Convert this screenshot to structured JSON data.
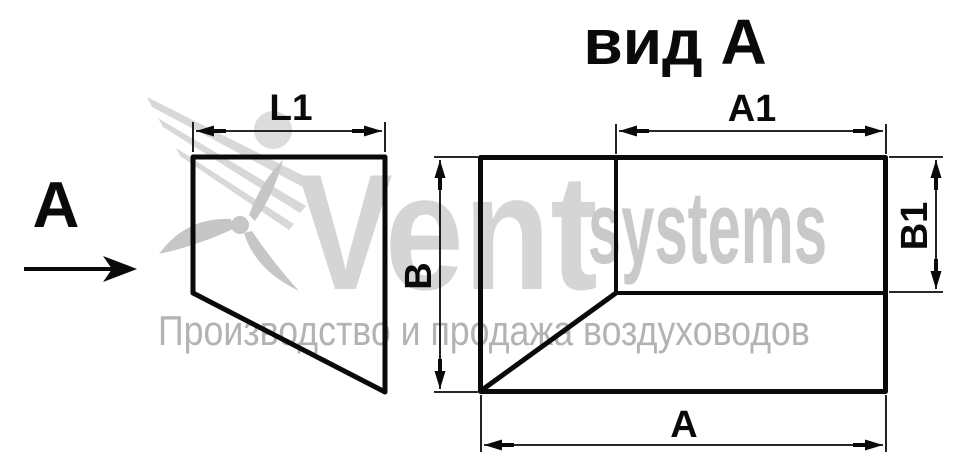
{
  "drawing": {
    "side_view": {
      "view_direction_label": "А",
      "dim_top_label": "L1"
    },
    "view_a": {
      "title": "вид А",
      "dim_top_label": "А1",
      "dim_right_label": "В1",
      "dim_left_label": "В",
      "dim_bottom_label": "А"
    }
  },
  "watermark": {
    "brand_primary": "Vent",
    "brand_secondary": "systems",
    "tagline": "Производство и продажа воздуховодов"
  },
  "colors": {
    "line": "#0a0a0a",
    "watermark_light": "#d5d5d5",
    "watermark_mid": "#c9c9c9",
    "watermark_tagline": "#b3b3b3"
  },
  "icons": {
    "logo": "fan-logo-icon"
  }
}
